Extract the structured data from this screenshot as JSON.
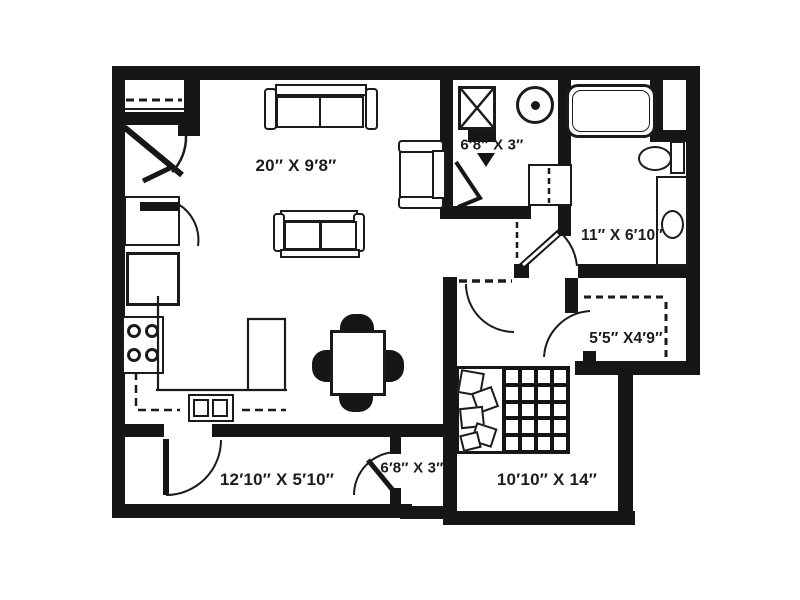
{
  "plan": {
    "type": "apartment floor plan",
    "labels": {
      "living": "20″ X 9′8″",
      "laundry": "6′8″ X 3″",
      "bathroom": "11″ X 6′10″",
      "walk_in_closet": "5′5″ X4′9″",
      "entry_closet": "6′8″ X 3″",
      "patio": "12′10″ X 5′10″",
      "bedroom": "10′10″ X 14″"
    },
    "fixtures": [
      "coat-closet",
      "entry-door",
      "pantry",
      "refrigerator",
      "stove",
      "kitchen-sink",
      "kitchen-counter",
      "dining-table",
      "sofa",
      "loveseat",
      "armchair",
      "washer",
      "dryer",
      "bathtub",
      "toilet",
      "vanity-sink",
      "walk-in-closet-shelves",
      "bed",
      "patio-door"
    ],
    "colors": {
      "walls": "#161616",
      "background": "#ffffff",
      "label_text": "#1c1c1c"
    }
  }
}
